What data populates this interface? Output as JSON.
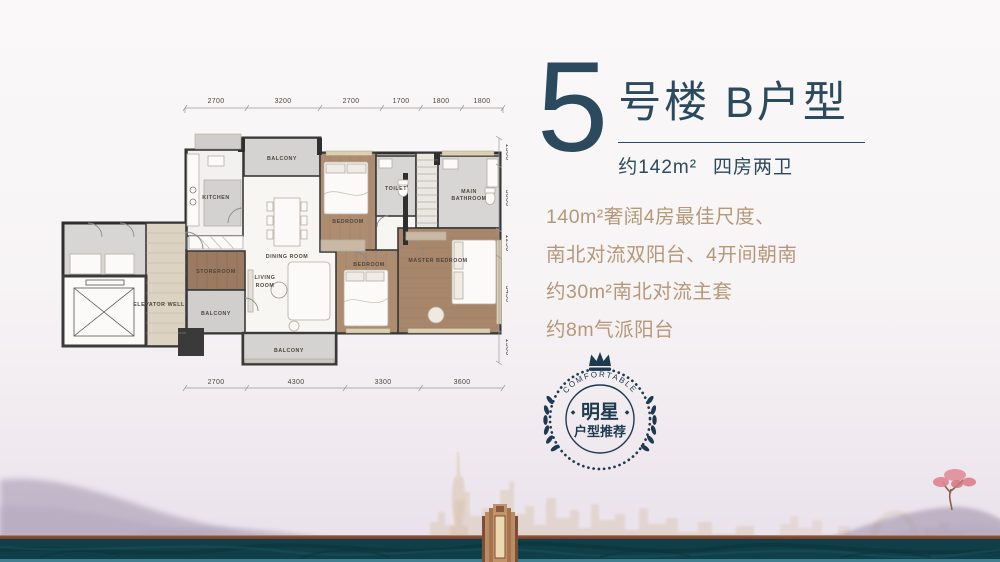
{
  "colors": {
    "accent_navy": "#2c4a5e",
    "feature_tan": "#b49878",
    "badge_navy": "#1e3a4f",
    "band_teal": "#113f48",
    "band_brown": "#8a4c36",
    "band_bottom_light": "#3f7f90",
    "skyline_tan": "#d9c3ae",
    "mountain_purple": "#9a8ca6",
    "tree_pink": "#dd8390",
    "tower_bronze": "#b98a62",
    "wood_floor": "#ad8c70",
    "wall_dark": "#2f2f2f"
  },
  "header": {
    "building_number": "5",
    "title": "号楼 B户型",
    "area": "约142m²",
    "layout": "四房两卫"
  },
  "features": [
    "140m²奢阔4房最佳尺度、",
    "南北对流双阳台、4开间朝南",
    "约30m²南北对流主套",
    "约8m气派阳台"
  ],
  "badge": {
    "arc_text": "COMFORTABLE",
    "title": "明星",
    "subtitle": "户型推荐"
  },
  "floorplan": {
    "rooms": {
      "kitchen": "KITCHEN",
      "balcony_top": "BALCONY",
      "dining": "DINING ROOM",
      "bedroom_top": "BEDROOM",
      "toilet": "TOILET",
      "main_bath_line1": "MAIN",
      "main_bath_line2": "BATHROOM",
      "storeroom": "STOREROOM",
      "living_line1": "LIVING",
      "living_line2": "ROOM",
      "balcony_left": "BALCONY",
      "balcony_bottom": "BALCONY",
      "bedroom_bottom": "BEDROOM",
      "master_bedroom": "MASTER BEDROOM",
      "elevator": "ELEVATOR WELL"
    },
    "dims_top": [
      "2700",
      "3200",
      "2700",
      "1700",
      "1800",
      "1800"
    ],
    "dims_bottom": [
      "2700",
      "4300",
      "3300",
      "3600"
    ],
    "dims_right": [
      "1300",
      "3000",
      "1250",
      "3450",
      "1500"
    ]
  }
}
